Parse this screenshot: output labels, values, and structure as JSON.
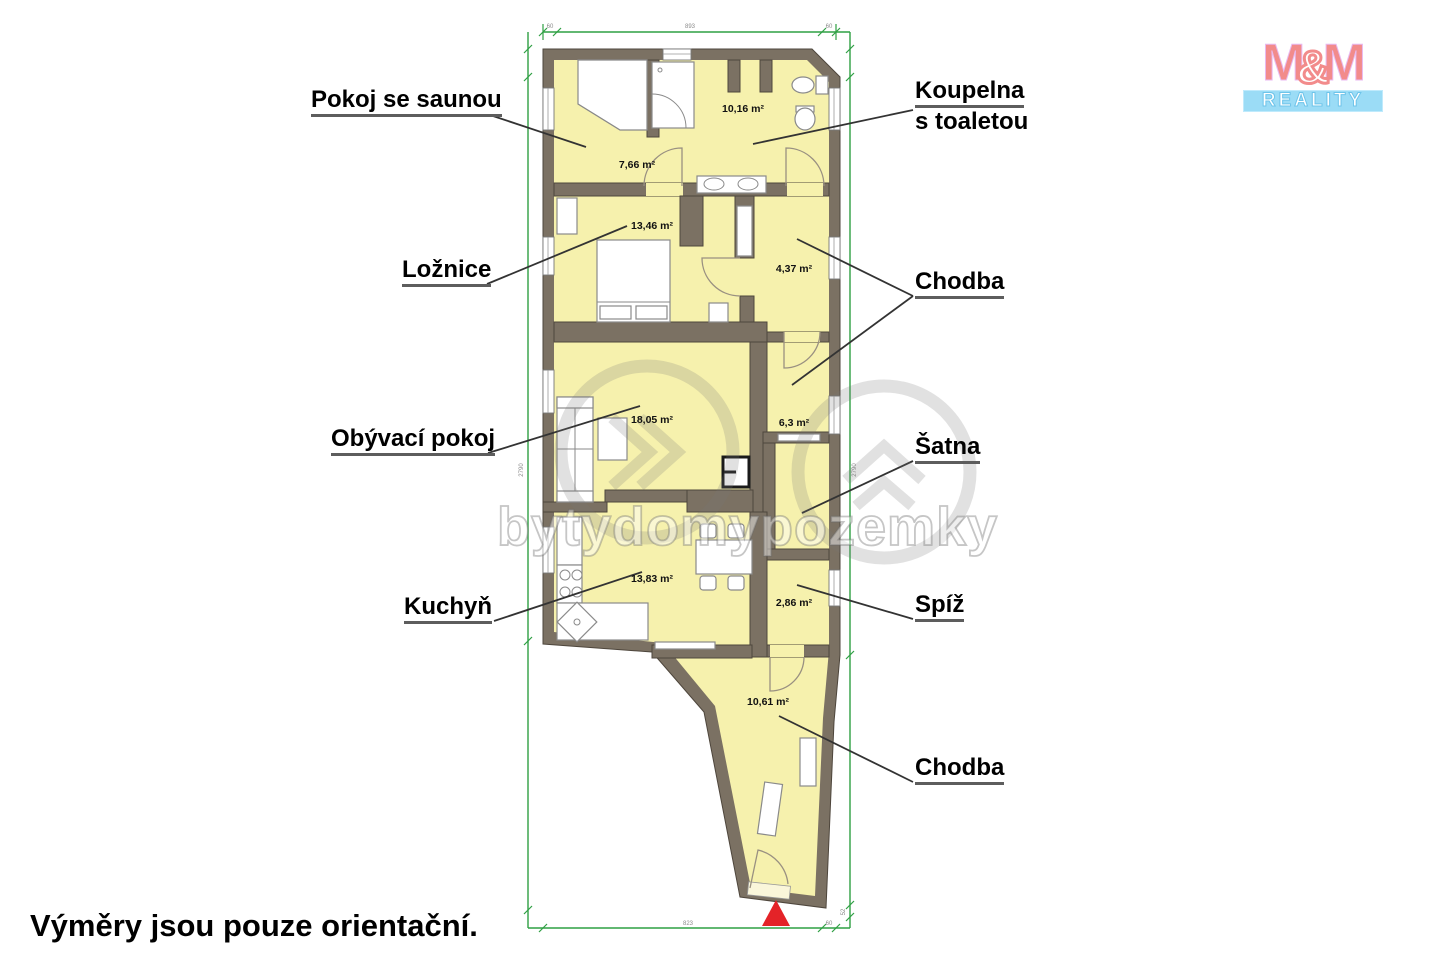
{
  "page": {
    "footnote": "Výměry jsou pouze orientační."
  },
  "branding": {
    "m_left": "M",
    "amp": "&",
    "m_right": "M",
    "reality": "REALITY"
  },
  "watermark": {
    "text": "bytydomypozemky"
  },
  "rooms": [
    {
      "id": "pokoj-se-saunou",
      "label": "Pokoj se saunou",
      "area": "7,66 m²"
    },
    {
      "id": "koupelna-s-toaletou",
      "label": "Koupelna s toaletou",
      "label_line1": "Koupelna",
      "label_line2": "s toaletou",
      "area": "10,16 m²"
    },
    {
      "id": "loznice",
      "label": "Ložnice",
      "area": "13,46 m²"
    },
    {
      "id": "chodba-horni",
      "label": "Chodba",
      "area": "4,37 m²"
    },
    {
      "id": "obyvaci-pokoj",
      "label": "Obývací pokoj",
      "area": "18,05 m²"
    },
    {
      "id": "satna",
      "label": "Šatna",
      "area": "6,3 m²"
    },
    {
      "id": "kuchyn",
      "label": "Kuchyň",
      "area": "13,83 m²"
    },
    {
      "id": "spiz",
      "label": "Spíž",
      "area": "2,86 m²"
    },
    {
      "id": "chodba-dolni",
      "label": "Chodba",
      "area": "10,61 m²"
    }
  ],
  "dimensions": {
    "top_left": "60",
    "top_mid": "893",
    "top_right": "60",
    "left_side": "2790",
    "right_side": "2790",
    "bottom_mid": "823",
    "bottom_right": "60",
    "right_bottom": "52"
  }
}
